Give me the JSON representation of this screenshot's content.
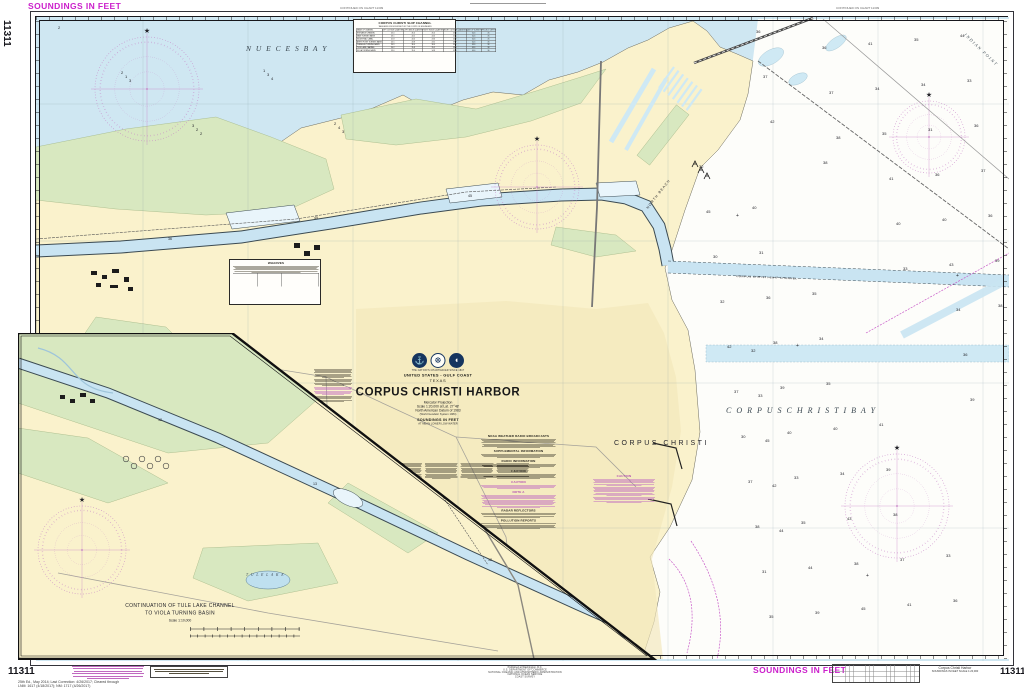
{
  "chart": {
    "number": "11311",
    "region": "UNITED STATES - GULF COAST",
    "state": "TEXAS",
    "title": "CORPUS CHRISTI HARBOR",
    "chartmaker_line": "THE NATION'S CHARTMAKER SINCE 1807",
    "projection": "Mercator Projection",
    "scale": "Scale 1:20,000 at Lat. 27°48'",
    "datum": "North American Datum of 1983",
    "datum2": "(World Geodetic System 1984)",
    "soundings_unit": "SOUNDINGS IN FEET",
    "datum_note": "AT MEAN LOWER LOW WATER"
  },
  "margins": {
    "top_left_soundings": "SOUNDINGS IN FEET",
    "bottom_right_soundings": "SOUNDINGS IN FEET",
    "left_chart_number": "11311",
    "bottom_left_chart_number": "11311",
    "bottom_right_chart_number": "11311",
    "edition_line1": "25th Ed., May 2014; Last Correction: 4/26/2017; Cleared through",
    "edition_line2": "LNM: 1617 (4/18/2017); NM: 1717 (4/26/2017)",
    "continued_left": "CONTINUED ON CHART 11309",
    "continued_right": "CONTINUED ON CHART 11309",
    "bottom_right_title": "Corpus Christi Harbor",
    "bottom_right_sub": "SOUNDINGS IN FEET   SCALE 1:20,000",
    "publisher": [
      "Published at Washington, D.C.",
      "U.S. DEPARTMENT OF COMMERCE",
      "NATIONAL OCEANIC AND ATMOSPHERIC ADMINISTRATION",
      "NATIONAL OCEAN SERVICE",
      "COAST SURVEY"
    ]
  },
  "labels": {
    "nueces_bay": "N U E C E S     B A Y",
    "corpus_christi_bay": "C O R P U S    C H R I S T I    B A Y",
    "corpus_christi": "CORPUS CHRISTI",
    "north_beach": "NORTH BEACH",
    "indian_point": "INDIAN POINT",
    "ship_channel": "CORPUS CHRISTI SHIP CHANNEL",
    "tule_lake": "T U L E   L A K E"
  },
  "inset": {
    "title_line1": "CONTINUATION OF TULE LAKE CHANNEL",
    "title_line2": "TO VIOLA TURNING BASIN",
    "scale": "Scale 1:10,000"
  },
  "notes": {
    "weather": "NOAA WEATHER RADIO BROADCASTS",
    "supplemental": "SUPPLEMENTAL INFORMATION",
    "radio": "RADIO INFORMATION",
    "caution1": "CAUTION",
    "caution2": "CAUTION",
    "note_a": "NOTE A",
    "radar": "RADAR REFLECTORS",
    "pollution": "POLLUTION REPORTS"
  },
  "tabulation": {
    "title": "CORPUS CHRISTI SHIP CHANNEL",
    "subtitle": "TABULATED FROM SURVEYS BY THE CORPS OF ENGINEERS",
    "headers": [
      "NAME OF CHANNEL",
      "LEFT OUTSIDE QUARTER",
      "LEFT INSIDE QUARTER",
      "RIGHT INSIDE QUARTER",
      "RIGHT OUTSIDE QUARTER",
      "DATE OF SURVEY",
      "PROJECT DEPTH"
    ],
    "rows": [
      [
        "ENTRANCE CHANNEL",
        "45.0",
        "45.0",
        "45.0",
        "45.0",
        "6-16",
        "45"
      ],
      [
        "MAIN TURNING BASIN",
        "43.1",
        "44.2",
        "44.0",
        "42.5",
        "6-16",
        "45"
      ],
      [
        "INDUSTRIAL CANAL",
        "41.8",
        "44.0",
        "43.6",
        "40.2",
        "6-16",
        "45"
      ],
      [
        "AVERY POINT TURNING BASIN",
        "40.5",
        "43.8",
        "43.2",
        "39.7",
        "6-16",
        "45"
      ],
      [
        "CHEMICAL TURNING BASIN",
        "34.9",
        "36.0",
        "36.0",
        "35.1",
        "6-16",
        "36"
      ],
      [
        "TULE LAKE CHANNEL",
        "34.2",
        "35.8",
        "35.5",
        "33.9",
        "6-16",
        "36"
      ],
      [
        "VIOLA TURNING BASIN",
        "33.6",
        "35.0",
        "34.8",
        "32.8",
        "6-16",
        "36"
      ]
    ]
  },
  "wharves": {
    "title": "WHARVES"
  },
  "soundings": {
    "bay": [
      36,
      38,
      35,
      41,
      33,
      37,
      40,
      34,
      39,
      36,
      42,
      31,
      35,
      38,
      44,
      32,
      36,
      40,
      37,
      33,
      45,
      38,
      34,
      41,
      36,
      30,
      39,
      43,
      35,
      37,
      32,
      40,
      38,
      34,
      36,
      42,
      33,
      45,
      31,
      39,
      37,
      35,
      41,
      36,
      38,
      30,
      44,
      34,
      40,
      32,
      37,
      39,
      35,
      43,
      33,
      38,
      36,
      41,
      34,
      45,
      31,
      37,
      40,
      36,
      42,
      35,
      38,
      33,
      39,
      44
    ],
    "nueces": [
      2,
      3,
      2,
      4,
      3,
      1,
      2,
      3,
      4,
      2,
      3,
      1,
      2
    ],
    "channel": [
      45,
      45,
      36
    ],
    "inset": [
      12,
      13,
      12
    ]
  }
}
